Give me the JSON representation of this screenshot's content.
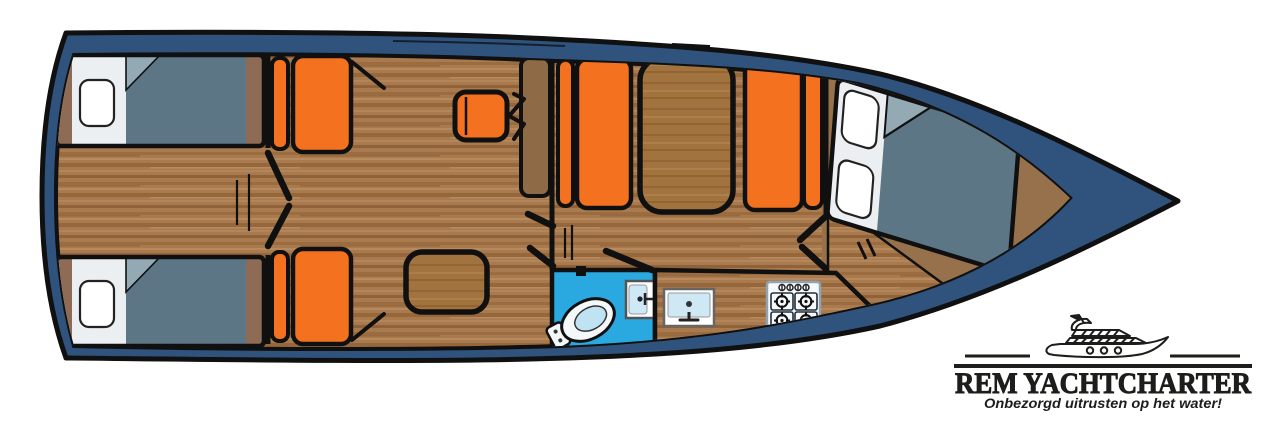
{
  "canvas": {
    "width": 1276,
    "height": 425,
    "background": "#FFFFFF"
  },
  "logo": {
    "title": "REM YACHTCHARTER",
    "tagline": "Onbezorgd uitrusten op het water!",
    "icon": "motor-yacht-line-icon",
    "text_color": "#1D1D1B"
  },
  "floorplan": {
    "type": "yacht-interior-top-view",
    "orientation": "bow pointing right, stern at left",
    "colors": {
      "hull_navy": "#2F537D",
      "outline_black": "#101010",
      "floor_wood": "#A87A4E",
      "wood_trim": "#8D6B55",
      "cushion_orange": "#F4721F",
      "bed_blanket": "#5C7685",
      "bed_fold": "#93A9B3",
      "bed_sheet": "#EBEFF1",
      "pillow_white": "#FFFFFF",
      "table_wood": "#A1743F",
      "bathroom_blue": "#2AA9E0",
      "fixture_basin": "#CFE8F6"
    },
    "rooms": [
      {
        "name": "aft-cabin-port",
        "furniture": [
          "single bed with pillow",
          "wood headboard"
        ]
      },
      {
        "name": "aft-cabin-starboard",
        "furniture": [
          "single bed with pillow",
          "wood headboard"
        ]
      },
      {
        "name": "corridor",
        "furniture": [
          "steps marker",
          "double cabin doors"
        ]
      },
      {
        "name": "salon",
        "furniture": [
          "orange bench seat port",
          "orange bench seat starboard",
          "helm seat",
          "side table",
          "side cabinet"
        ]
      },
      {
        "name": "dinette",
        "furniture": [
          "orange bench left",
          "dinette table",
          "orange bench right"
        ]
      },
      {
        "name": "bathroom",
        "furniture": [
          "toilet",
          "washbasin",
          "door"
        ]
      },
      {
        "name": "galley",
        "furniture": [
          "sink",
          "stove with 4 burners and 4 knobs"
        ]
      },
      {
        "name": "bow-cabin",
        "furniture": [
          "double bed with two pillows",
          "entry steps",
          "double doors"
        ]
      }
    ]
  }
}
